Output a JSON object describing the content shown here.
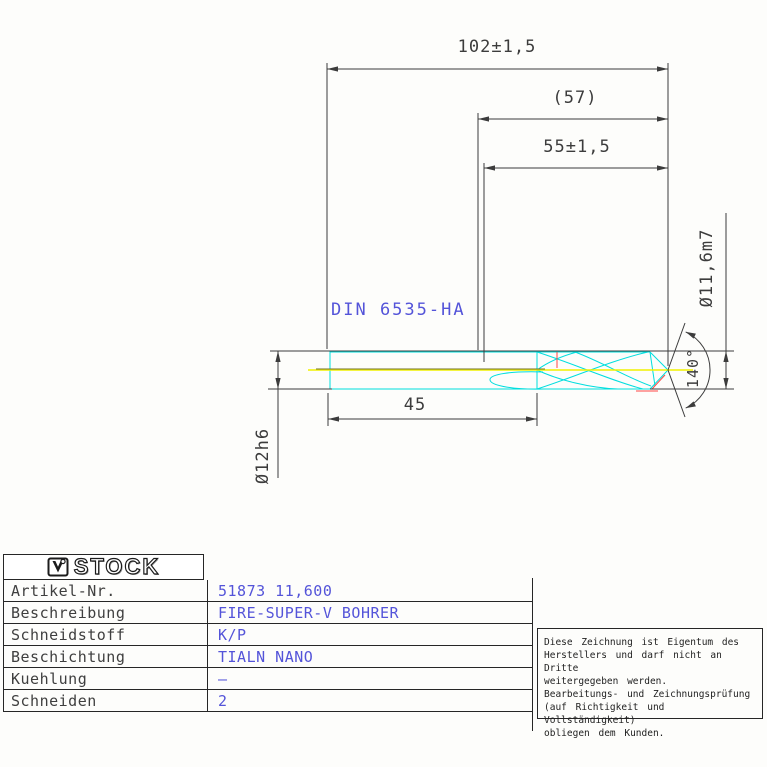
{
  "drawing": {
    "labels": {
      "overall_length": "102±1,5",
      "length_ref": "(57)",
      "flute_length": "55±1,5",
      "shank_length": "45",
      "shank_diameter": "Ø12h6",
      "cutting_diameter": "Ø11,6m7",
      "point_angle": "140°",
      "shank_norm": "DIN 6535-HA"
    },
    "colors": {
      "dimension_gray": "#3c3c3c",
      "contour_cyan": "#00dede",
      "centerline_yellow": "#f2f200",
      "highlight_red": "#ff4646",
      "annotation_blue": "#5454d9"
    }
  },
  "title_block": {
    "logo_text": "STOCK",
    "rows": [
      {
        "label": "Artikel-Nr.",
        "value": "51873 11,600"
      },
      {
        "label": "Beschreibung",
        "value": "FIRE-SUPER-V BOHRER"
      },
      {
        "label": "Schneidstoff",
        "value": "K/P"
      },
      {
        "label": "Beschichtung",
        "value": "TIALN NANO"
      },
      {
        "label": "Kuehlung",
        "value": "–"
      },
      {
        "label": "Schneiden",
        "value": "2"
      }
    ]
  },
  "note": {
    "lines": [
      "Diese Zeichnung ist Eigentum des",
      "Herstellers und darf nicht an Dritte",
      "weitergegeben werden.",
      "Bearbeitungs- und Zeichnungsprüfung",
      "(auf Richtigkeit und Vollständigkeit)",
      "obliegen dem Kunden."
    ]
  }
}
